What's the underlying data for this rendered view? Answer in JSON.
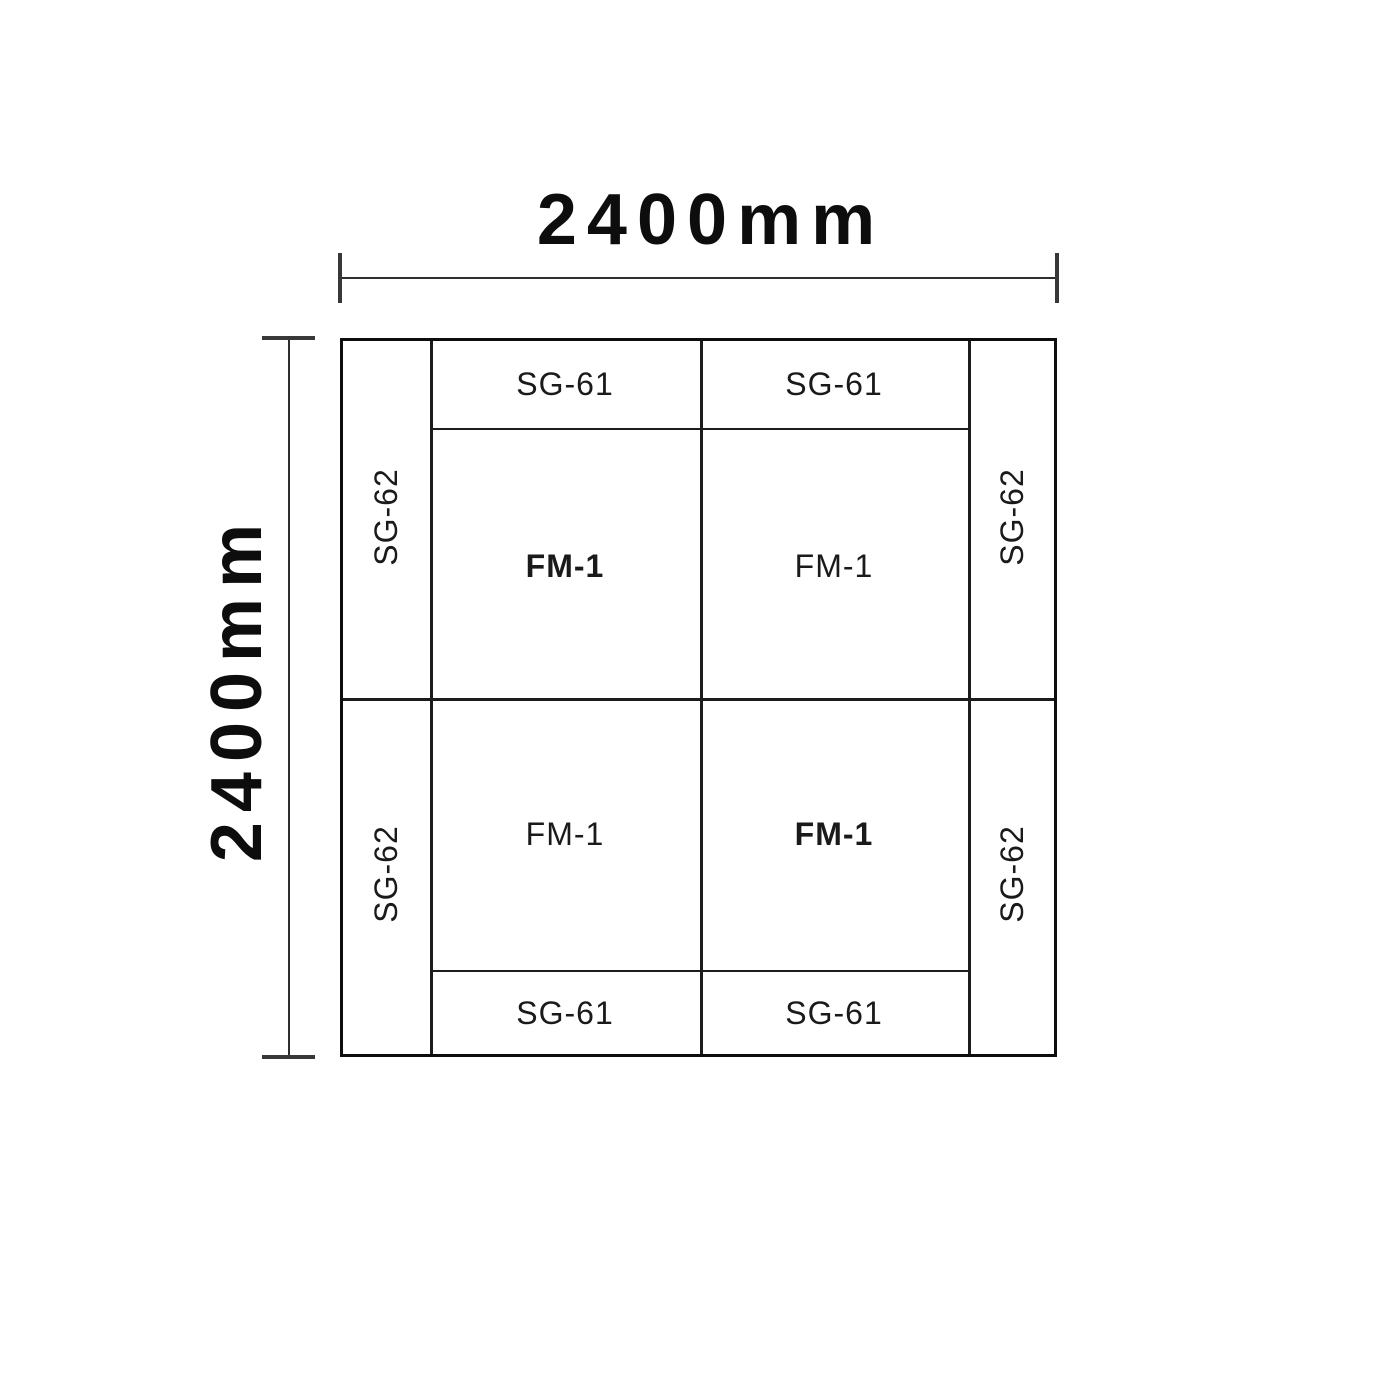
{
  "dimensions": {
    "width_label": "2400mm",
    "height_label": "2400mm"
  },
  "cells": {
    "sg61_top_left": "SG-61",
    "sg61_top_right": "SG-61",
    "sg61_bottom_left": "SG-61",
    "sg61_bottom_right": "SG-61",
    "sg62_left_top": "SG-62",
    "sg62_left_bottom": "SG-62",
    "sg62_right_top": "SG-62",
    "sg62_right_bottom": "SG-62",
    "fm1_top_left": "FM-1",
    "fm1_top_right": "FM-1",
    "fm1_bottom_left": "FM-1",
    "fm1_bottom_right": "FM-1"
  },
  "colors": {
    "background": "#ffffff",
    "plan_line": "#0d0d0d",
    "grid_line": "#1c1c1c",
    "dimension_line": "#2e2e2e",
    "text": "#111111"
  }
}
